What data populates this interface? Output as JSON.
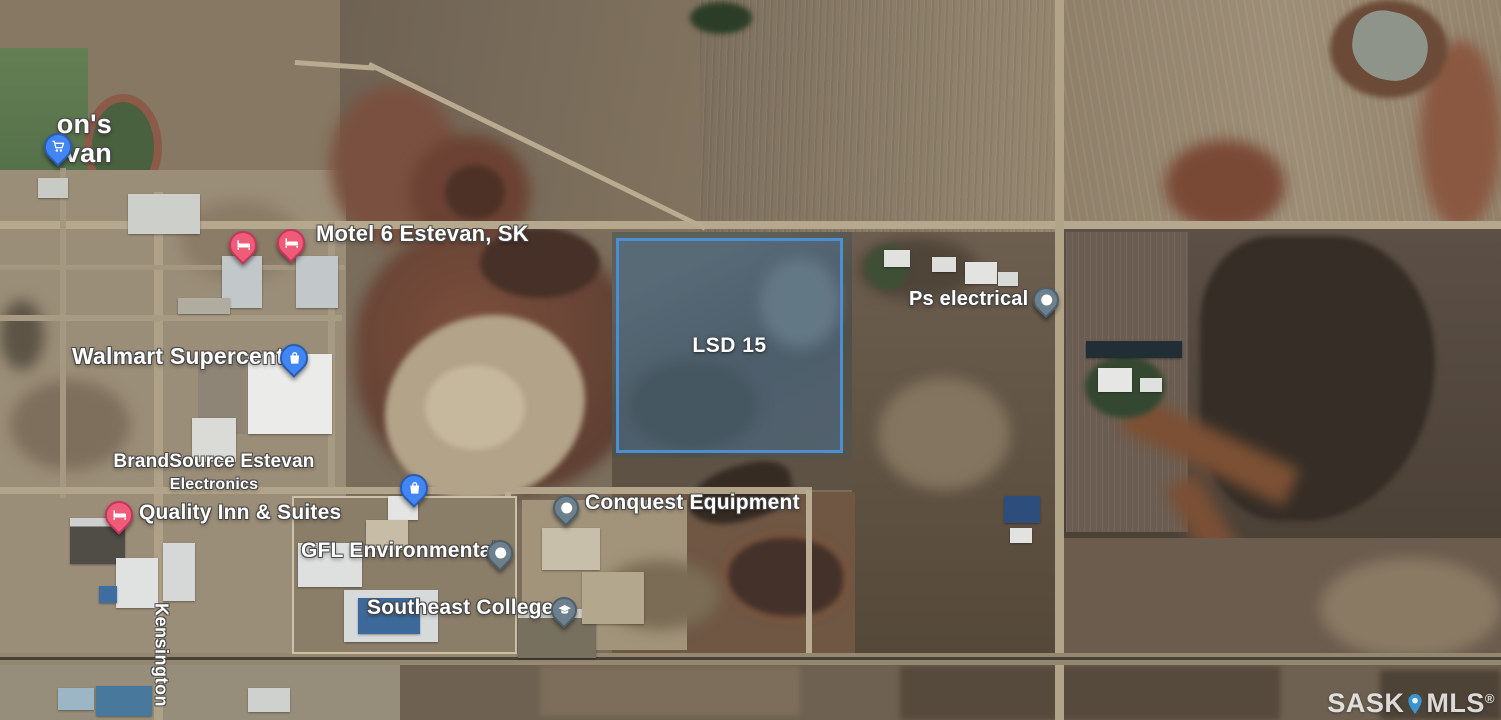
{
  "map": {
    "partial_store_label": {
      "line1": "on's",
      "line2": "evan"
    },
    "pois": {
      "store_nw": {
        "icon": "shopping-cart-pin",
        "color": "blue"
      },
      "motel6": {
        "label": "Motel 6 Estevan, SK",
        "icon": "hotel-bed-pin",
        "color": "pink"
      },
      "walmart": {
        "label": "Walmart Supercentre",
        "icon": "shopping-bag-pin",
        "color": "blue"
      },
      "brandsource": {
        "label": "BrandSource Estevan",
        "sublabel": "Electronics"
      },
      "quality_inn": {
        "label": "Quality Inn & Suites",
        "icon": "hotel-bed-pin",
        "color": "pink"
      },
      "store_mid": {
        "icon": "shopping-bag-pin",
        "color": "blue"
      },
      "gfl": {
        "label": "GFL Environmental",
        "icon": "place-pin",
        "color": "gray"
      },
      "conquest": {
        "label": "Conquest Equipment",
        "icon": "place-pin",
        "color": "gray"
      },
      "southeast_college": {
        "label": "Southeast College",
        "icon": "graduation-cap-pin",
        "color": "gray"
      },
      "ps_electrical": {
        "label": "Ps electrical",
        "icon": "place-pin",
        "color": "gray"
      }
    },
    "parcel": {
      "label": "LSD 15"
    },
    "road_label": {
      "name": "Kensington"
    },
    "watermark": {
      "left": "SASK",
      "right": "MLS",
      "reg": "®"
    },
    "colors": {
      "parcel_border": "#4d8dd2",
      "parcel_fill": "rgba(77,130,190,0.30)",
      "pin_blue": "#4285f4",
      "pin_pink": "#ef5c77",
      "pin_gray": "#6d808d"
    }
  }
}
